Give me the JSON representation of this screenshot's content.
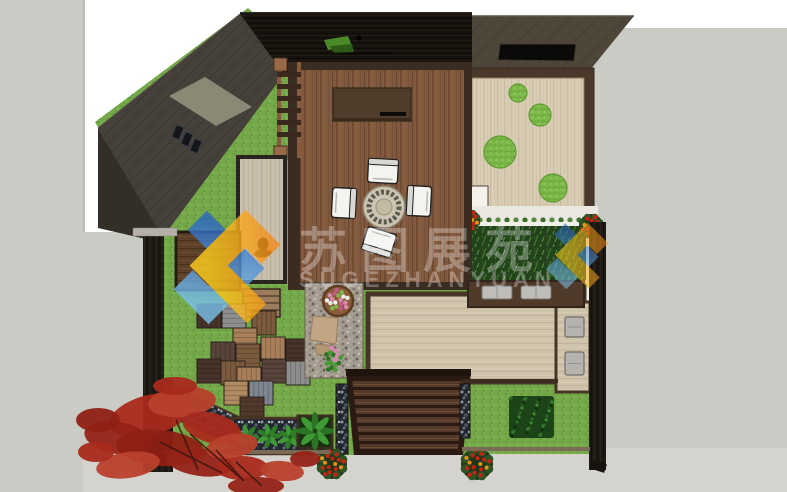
{
  "meta": {
    "title": "Courtyard landscape design - top view rendering",
    "canvas_width": 787,
    "canvas_height": 492
  },
  "watermark": {
    "cn": "苏图展苑",
    "en": "SUGEZHANYUAN",
    "text_color": "#ffffff",
    "logo_blue_start": "#2b66c4",
    "logo_blue_end": "#7cc2ec",
    "logo_yellow_start": "#ffd01e",
    "logo_yellow_end": "#ef7d1a"
  },
  "palette": {
    "background": "#cbcbc5",
    "backdrop": "#ffffff",
    "sidewalk": "#d4d3ce",
    "lawn": "#74a848",
    "deck": "#83593e",
    "dark_roof": "#16120e",
    "sloped_roof": "#45403a",
    "olive_roof": "#4e4639",
    "zen_gravel": "#d9cdb5",
    "patio": "#cfc3ab",
    "pergola": "#54392a",
    "bamboo": "#24421c",
    "fence": "#1d1914",
    "maple_colors": [
      "#a82a1c",
      "#962317",
      "#b8402c",
      "#8f2014"
    ],
    "basket_flower_colors": [
      "#d98ab0",
      "#efefec",
      "#7cb84a",
      "#c45a8a"
    ]
  },
  "scene": {
    "tiles": [
      {
        "x": 197,
        "y": 304,
        "c": "#46332a",
        "d": "v"
      },
      {
        "x": 222,
        "y": 304,
        "c": "#8d8d8d",
        "d": "h"
      },
      {
        "x": 252,
        "y": 311,
        "c": "#7b5a3d",
        "d": "v"
      },
      {
        "x": 233,
        "y": 328,
        "c": "#a87f58",
        "d": "h"
      },
      {
        "x": 211,
        "y": 342,
        "c": "#57443b",
        "d": "v"
      },
      {
        "x": 236,
        "y": 344,
        "c": "#7b5a3d",
        "d": "h"
      },
      {
        "x": 261,
        "y": 337,
        "c": "#a87f58",
        "d": "v"
      },
      {
        "x": 286,
        "y": 339,
        "c": "#46332a",
        "d": "h"
      },
      {
        "x": 197,
        "y": 359,
        "c": "#46332a",
        "d": "h"
      },
      {
        "x": 221,
        "y": 361,
        "c": "#7b5a3d",
        "d": "v"
      },
      {
        "x": 262,
        "y": 359,
        "c": "#57443b",
        "d": "h"
      },
      {
        "x": 286,
        "y": 361,
        "c": "#8d8d8d",
        "d": "v"
      },
      {
        "x": 237,
        "y": 367,
        "c": "#a87f58",
        "d": "v"
      },
      {
        "x": 224,
        "y": 381,
        "c": "#b08a60",
        "d": "h"
      },
      {
        "x": 249,
        "y": 381,
        "c": "#7f8690",
        "d": "v"
      },
      {
        "x": 240,
        "y": 397,
        "c": "#50392c",
        "d": "h"
      }
    ],
    "moss_circles": [
      {
        "cx": 518,
        "cy": 93,
        "r": 9
      },
      {
        "cx": 540,
        "cy": 115,
        "r": 11
      },
      {
        "cx": 500,
        "cy": 152,
        "r": 16
      },
      {
        "cx": 553,
        "cy": 188,
        "r": 14
      }
    ],
    "chairs": [
      {
        "x": 383,
        "y": 171,
        "r": 3
      },
      {
        "x": 344,
        "y": 203,
        "r": 93
      },
      {
        "x": 419,
        "y": 201,
        "r": -87
      },
      {
        "x": 379,
        "y": 242,
        "r": 197
      }
    ],
    "cushions": [
      {
        "x": 482,
        "y": 286
      },
      {
        "x": 521,
        "y": 286
      }
    ],
    "stools": [
      {
        "x": 565,
        "y": 317,
        "w": 19,
        "h": 20
      },
      {
        "x": 565,
        "y": 352,
        "w": 19,
        "h": 23
      }
    ],
    "red_bushes": [
      {
        "cx": 470,
        "cy": 220,
        "r": 10
      },
      {
        "cx": 591,
        "cy": 226,
        "r": 12
      }
    ],
    "flower_pots": [
      {
        "cx": 332,
        "cy": 464,
        "r": 15
      },
      {
        "cx": 477,
        "cy": 464,
        "r": 16
      }
    ],
    "hostas": [
      {
        "cx": 247,
        "cy": 437
      },
      {
        "cx": 269,
        "cy": 436
      },
      {
        "cx": 290,
        "cy": 437
      },
      {
        "cx": 311,
        "cy": 438
      }
    ],
    "maple_blobs": [
      {
        "x": 150,
        "y": 415,
        "rx": 42,
        "ry": 20,
        "rot": -15,
        "c": 0
      },
      {
        "x": 118,
        "y": 438,
        "rx": 34,
        "ry": 16,
        "rot": 10,
        "c": 1
      },
      {
        "x": 182,
        "y": 402,
        "rx": 34,
        "ry": 15,
        "rot": -5,
        "c": 2
      },
      {
        "x": 212,
        "y": 428,
        "rx": 30,
        "ry": 15,
        "rot": 15,
        "c": 0
      },
      {
        "x": 160,
        "y": 448,
        "rx": 44,
        "ry": 18,
        "rot": 5,
        "c": 3
      },
      {
        "x": 128,
        "y": 465,
        "rx": 32,
        "ry": 13,
        "rot": -8,
        "c": 2
      },
      {
        "x": 200,
        "y": 462,
        "rx": 34,
        "ry": 14,
        "rot": 8,
        "c": 1
      },
      {
        "x": 242,
        "y": 468,
        "rx": 26,
        "ry": 12,
        "rot": 0,
        "c": 0
      },
      {
        "x": 282,
        "y": 471,
        "rx": 22,
        "ry": 10,
        "rot": 5,
        "c": 2
      },
      {
        "x": 305,
        "y": 459,
        "rx": 15,
        "ry": 8,
        "rot": 0,
        "c": 1
      },
      {
        "x": 232,
        "y": 446,
        "rx": 26,
        "ry": 12,
        "rot": -10,
        "c": 2
      },
      {
        "x": 98,
        "y": 420,
        "rx": 22,
        "ry": 12,
        "rot": 0,
        "c": 3
      },
      {
        "x": 96,
        "y": 452,
        "rx": 18,
        "ry": 10,
        "rot": 0,
        "c": 0
      },
      {
        "x": 256,
        "y": 486,
        "rx": 28,
        "ry": 9,
        "rot": 0,
        "c": 1
      },
      {
        "x": 175,
        "y": 386,
        "rx": 22,
        "ry": 9,
        "rot": 0,
        "c": 0
      }
    ]
  }
}
